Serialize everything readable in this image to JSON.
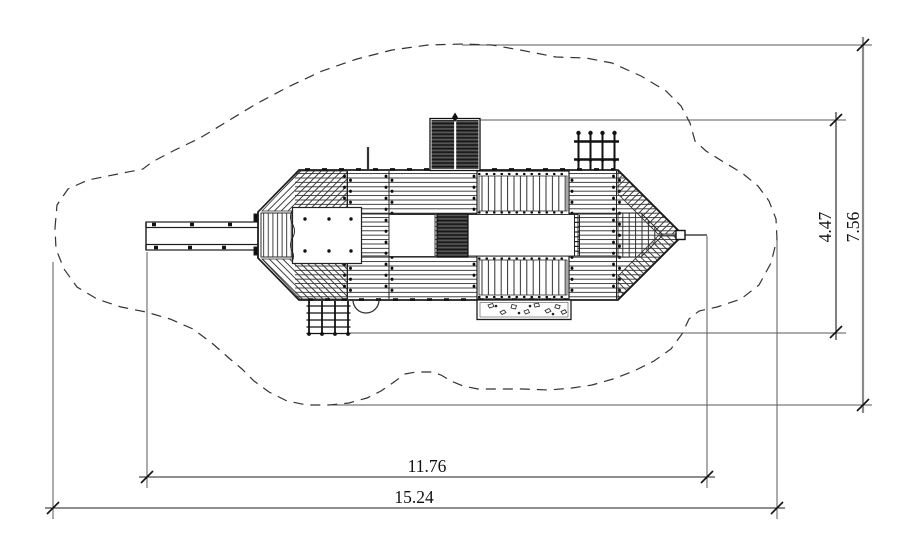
{
  "drawing": {
    "title": "playground structure plan view with safety zone",
    "dimensions": {
      "structure_width": "11.76",
      "safety_zone_width": "15.24",
      "structure_depth": "4.47",
      "safety_zone_depth": "7.56"
    },
    "colors": {
      "line": "#1c1c1c",
      "extension_line": "#5a5a5a",
      "gray_dimension": "#8a8a8a",
      "dark_fill": "#3f3f3f",
      "background": "#ffffff"
    }
  }
}
